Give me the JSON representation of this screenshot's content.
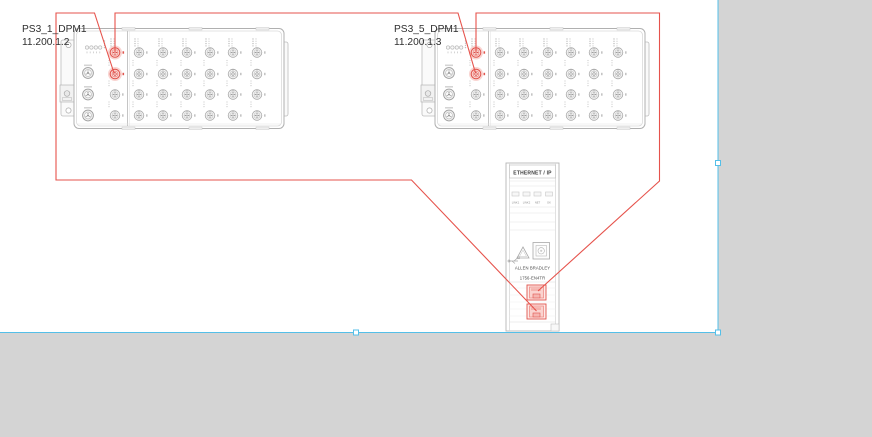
{
  "canvas": {
    "background_color": "#d4d4d4",
    "page_color": "#ffffff",
    "selection_color": "#54bfe8",
    "wire_color": "#e6534c",
    "highlight_color": "#e0544d"
  },
  "devices": [
    {
      "id": "panel-1",
      "label": "PS3_1_DPM1",
      "ip": "11.200.1.2",
      "highlighted_ports": 2
    },
    {
      "id": "panel-2",
      "label": "PS3_5_DPM1",
      "ip": "11.200.1.3",
      "highlighted_ports": 2
    }
  ],
  "module": {
    "header": "ETHERNET / IP",
    "led_labels": [
      "LINK1",
      "LINK2",
      "NET",
      "OK"
    ],
    "brand": "ALLEN BRADLEY",
    "model": "1756-EN4TR",
    "highlighted_ports": 2
  },
  "wires": [
    {
      "from": "PS3_1_DPM1 port 2",
      "to": "1756-EN4TR lower port"
    },
    {
      "from": "PS3_1_DPM1 port 1",
      "to": "PS3_5_DPM1 port 2"
    },
    {
      "from": "PS3_5_DPM1 port 1",
      "to": "1756-EN4TR upper port"
    }
  ]
}
